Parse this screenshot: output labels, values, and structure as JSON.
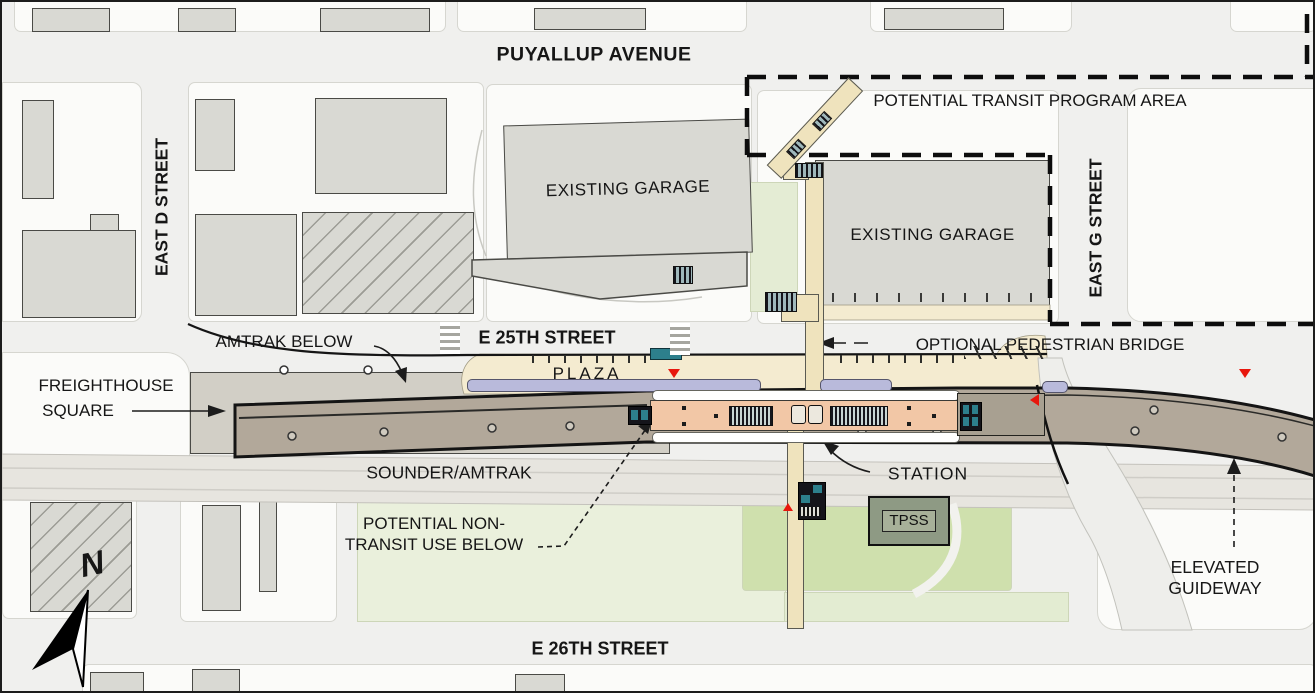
{
  "colors": {
    "street_bg": "#f0f0ee",
    "parcel": "#fbfbf9",
    "building": "#d9d9d3",
    "plaza": "#f4ebd0",
    "deck": "#b2a89a",
    "platform": "#f2c7a6",
    "lavender": "#b9badb",
    "green_light": "#eaf0dc",
    "green_lawn": "#cfe0ad",
    "teal": "#2d7f8c",
    "red": "#e8170d",
    "rail_band": "#e7e5df",
    "bridge_tan": "#efe3bd",
    "tpss_fill": "#8e9a84"
  },
  "streets": {
    "puyallup": "PUYALLUP AVENUE",
    "east_d": "EAST D STREET",
    "east_g": "EAST G STREET",
    "e_25th": "E 25TH STREET",
    "e_26th": "E 26TH STREET"
  },
  "labels": {
    "program_area": "POTENTIAL TRANSIT PROGRAM AREA",
    "garage_north": "EXISTING GARAGE",
    "garage_east": "EXISTING GARAGE",
    "amtrak_below": "AMTRAK BELOW",
    "plaza": "PLAZA",
    "pedestrian_bridge": "OPTIONAL PEDESTRIAN BRIDGE",
    "freighthouse_line1": "FREIGHTHOUSE",
    "freighthouse_line2": "SQUARE",
    "sounder": "SOUNDER/AMTRAK",
    "station": "STATION",
    "non_transit_line1": "POTENTIAL NON-",
    "non_transit_line2": "TRANSIT USE BELOW",
    "tpss": "TPSS",
    "elevated_line1": "ELEVATED",
    "elevated_line2": "GUIDEWAY",
    "compass_north": "N"
  }
}
